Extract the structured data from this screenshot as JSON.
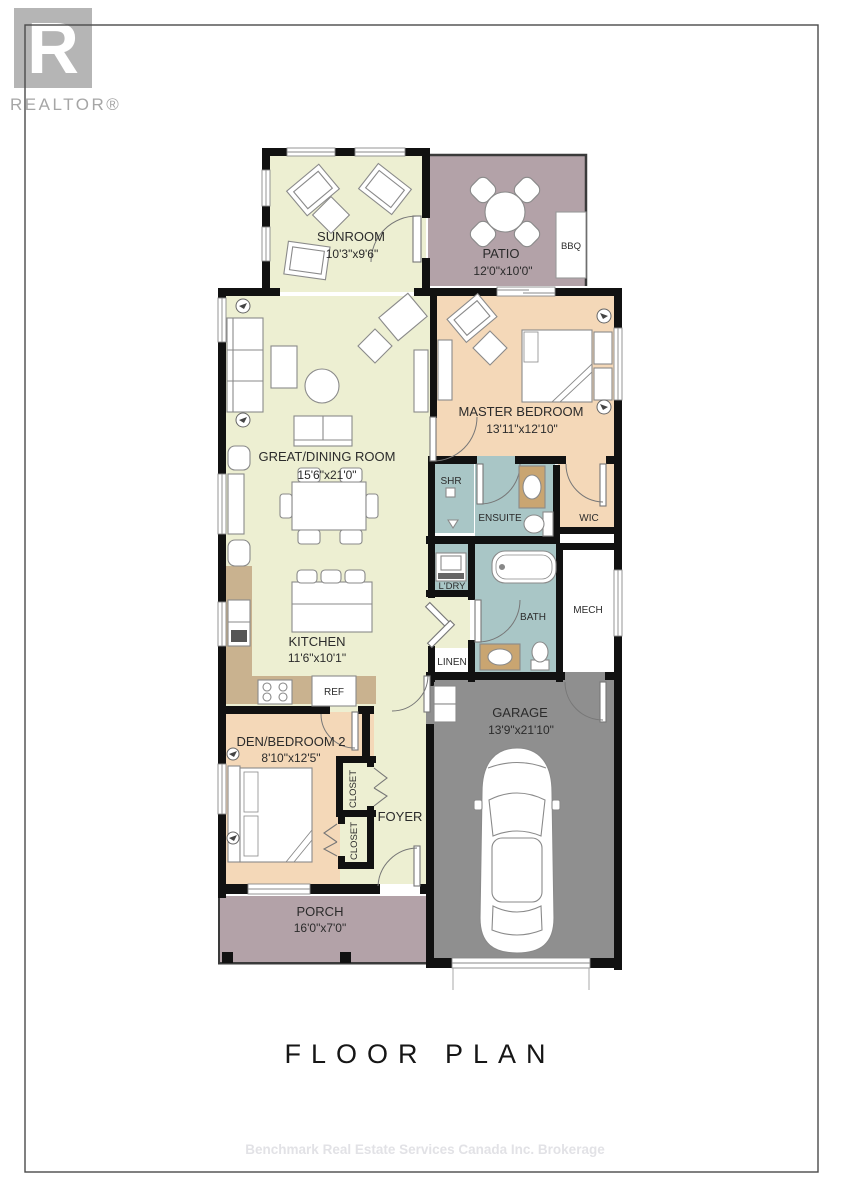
{
  "branding": {
    "logo_letter": "R",
    "logo_wordmark": "REALTOR®"
  },
  "rooms": {
    "sunroom": {
      "name": "SUNROOM",
      "dims": "10'3\"x9'6\""
    },
    "patio": {
      "name": "PATIO",
      "dims": "12'0\"x10'0\""
    },
    "bbq": {
      "label": "BBQ"
    },
    "master_bedroom": {
      "name": "MASTER BEDROOM",
      "dims": "13'11\"x12'10\""
    },
    "great_dining": {
      "name": "GREAT/DINING ROOM",
      "dims": "15'6\"x21'0\""
    },
    "shower": {
      "label": "SHR"
    },
    "ensuite": {
      "label": "ENSUITE"
    },
    "wic": {
      "label": "WIC"
    },
    "laundry": {
      "label": "L'DRY"
    },
    "bath": {
      "label": "BATH"
    },
    "mech": {
      "label": "MECH"
    },
    "linen": {
      "label": "LINEN"
    },
    "kitchen": {
      "name": "KITCHEN",
      "dims": "11'6\"x10'1\""
    },
    "fridge": {
      "label": "REF"
    },
    "garage": {
      "name": "GARAGE",
      "dims": "13'9\"x21'10\""
    },
    "den_bedroom2": {
      "name": "DEN/BEDROOM 2",
      "dims": "8'10\"x12'5\""
    },
    "closet_upper": {
      "label": "CLOSET"
    },
    "closet_lower": {
      "label": "CLOSET"
    },
    "foyer": {
      "label": "FOYER"
    },
    "porch": {
      "name": "PORCH",
      "dims": "16'0\"x7'0\""
    }
  },
  "footer": {
    "title": "FLOOR PLAN",
    "watermark": "Benchmark Real Estate Services Canada Inc. Brokerage"
  },
  "colors": {
    "floor_yellow": "#edefd2",
    "floor_peach": "#f4d8b8",
    "floor_teal": "#a9c6c6",
    "floor_mauve": "#b3a2a8",
    "garage_gray": "#8f8f8f",
    "counter_tan": "#c9b28f",
    "wall_black": "#111111",
    "logo_gray": "#b5b5b5"
  }
}
